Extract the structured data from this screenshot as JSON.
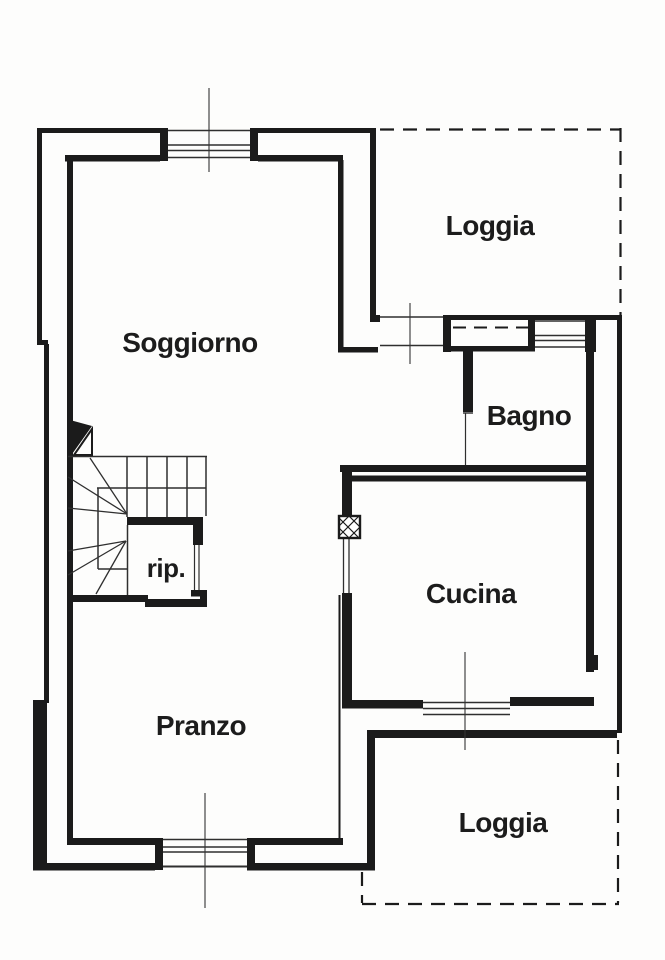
{
  "plan_title": "Apartment floor plan",
  "colors": {
    "line": "#1b1b1b",
    "thin_line": "#2f2f2f",
    "background": "#fdfdfc"
  },
  "rooms": [
    {
      "id": "soggiorno",
      "label": "Soggiorno"
    },
    {
      "id": "loggia_top",
      "label": "Loggia"
    },
    {
      "id": "bagno",
      "label": "Bagno"
    },
    {
      "id": "cucina",
      "label": "Cucina"
    },
    {
      "id": "ripostiglio",
      "label": "rip."
    },
    {
      "id": "pranzo",
      "label": "Pranzo"
    },
    {
      "id": "loggia_bottom",
      "label": "Loggia"
    }
  ]
}
